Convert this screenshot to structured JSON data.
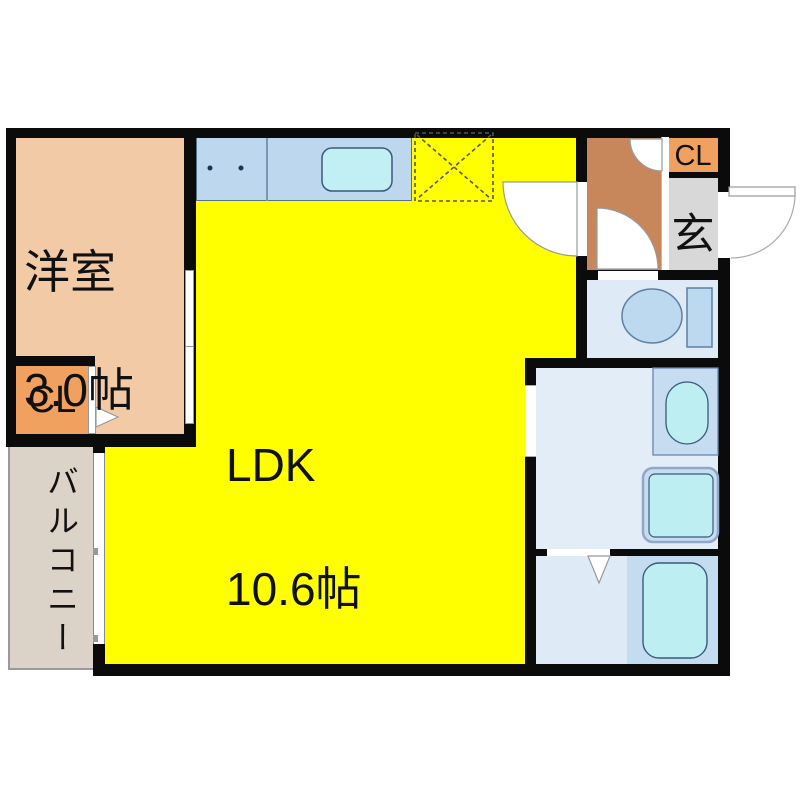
{
  "plan": {
    "title": "apartment-floorplan",
    "rooms": {
      "western_room": {
        "name": "洋室",
        "size": "3.0帖",
        "color": "#F2CBA6"
      },
      "ldk": {
        "name": "LDK",
        "size": "10.6帖",
        "color": "#FFFF00"
      },
      "closet_left": {
        "label": "CL",
        "color": "#F0A05F"
      },
      "closet_entrance": {
        "label": "CL",
        "color": "#F0A05F"
      },
      "genkan": {
        "label": "玄",
        "color": "#D8D8D8"
      },
      "balcony": {
        "label": "バルコニー",
        "color": "#DBD2C8"
      },
      "hallway": {
        "color": "#C8875A"
      },
      "toilet_room": {
        "color": "#DEEAF6"
      },
      "washroom": {
        "color": "#E2EDF8"
      },
      "bathroom": {
        "color": "#DEEAF6"
      },
      "bathtub_zone": {
        "color": "#C3DCF0"
      }
    },
    "fixtures": [
      "stove-burners",
      "kitchen-sink",
      "refrigerator-space",
      "toilet",
      "wash-basin",
      "washing-machine",
      "bathtub",
      "entrance-door",
      "room-doors",
      "sliding-doors",
      "balcony-window"
    ],
    "palette": {
      "wall": "#0b0b0b",
      "counter": "#BDD7EE",
      "fixture_panel": "#C5DCF1",
      "water_cyan": "#BCEEF2",
      "outline": "#3A5A7A",
      "door_line": "#999999"
    }
  }
}
